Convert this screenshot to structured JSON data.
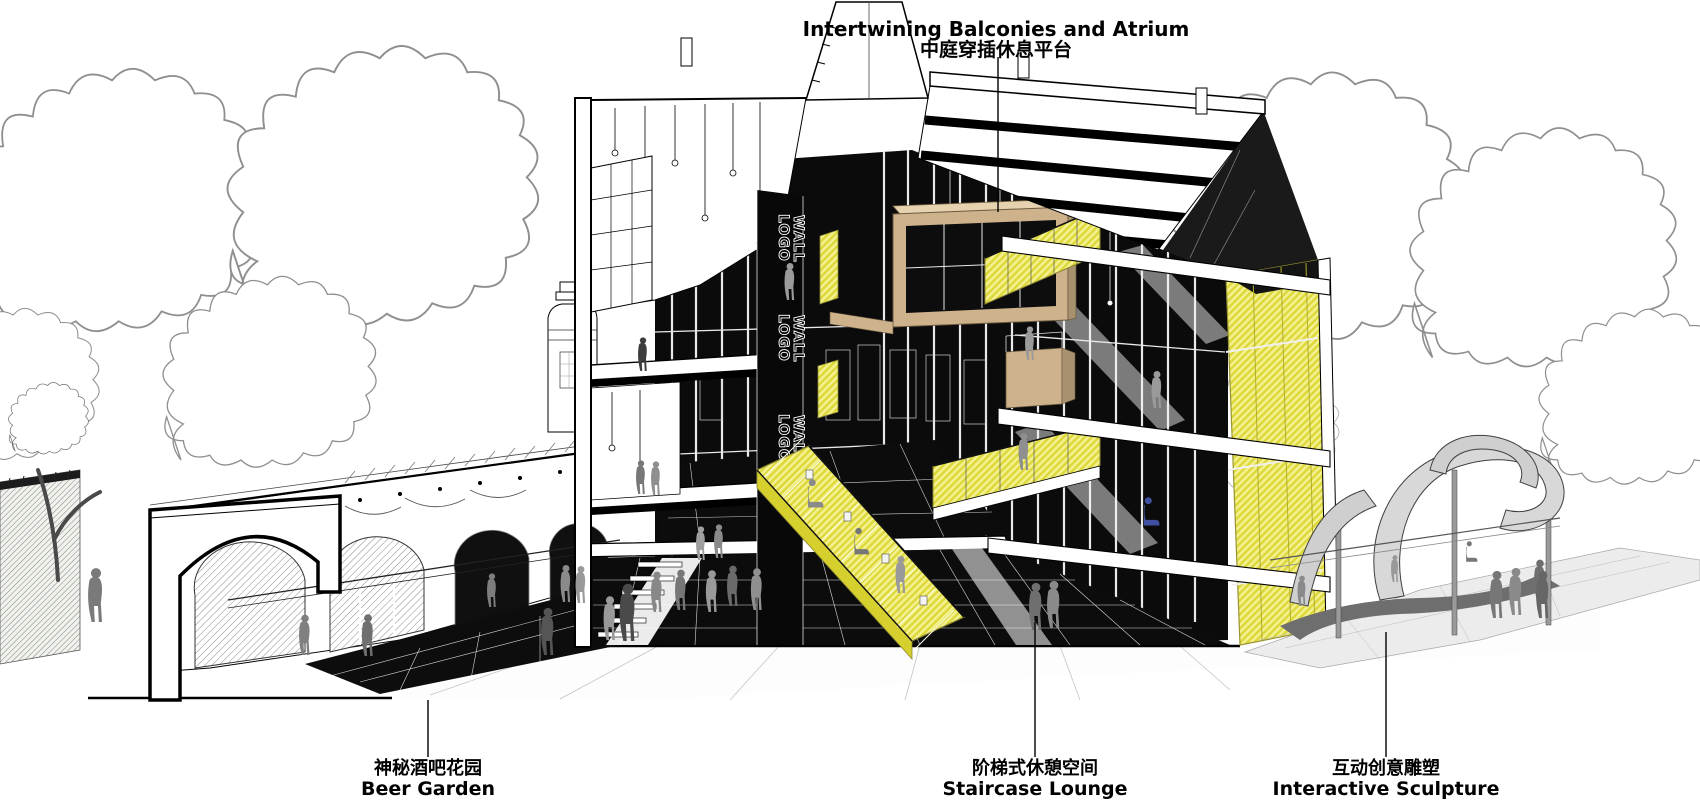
{
  "annotations": {
    "atrium": {
      "en": "Intertwining Balconies and Atrium",
      "zh": "中庭穿插休息平台"
    },
    "beer_garden": {
      "zh": "神秘酒吧花园",
      "en": "Beer Garden"
    },
    "staircase_lounge": {
      "zh": "阶梯式休憩空间",
      "en": "Staircase Lounge"
    },
    "interactive_sculpture": {
      "zh": "互动创意雕塑",
      "en": "Interactive Sculpture"
    }
  },
  "building": {
    "logo_wall": {
      "line1": "LOGO",
      "line2": "WALL"
    }
  },
  "colors": {
    "accent_yellow": "#ece751",
    "accent_yellow_light": "#f3f18e",
    "wood": "#cdb28c",
    "figure_gray": "#8a8a8a",
    "figure_blue": "#4050a0",
    "ink": "#000000",
    "tree_outline": "#8f8f8f"
  }
}
